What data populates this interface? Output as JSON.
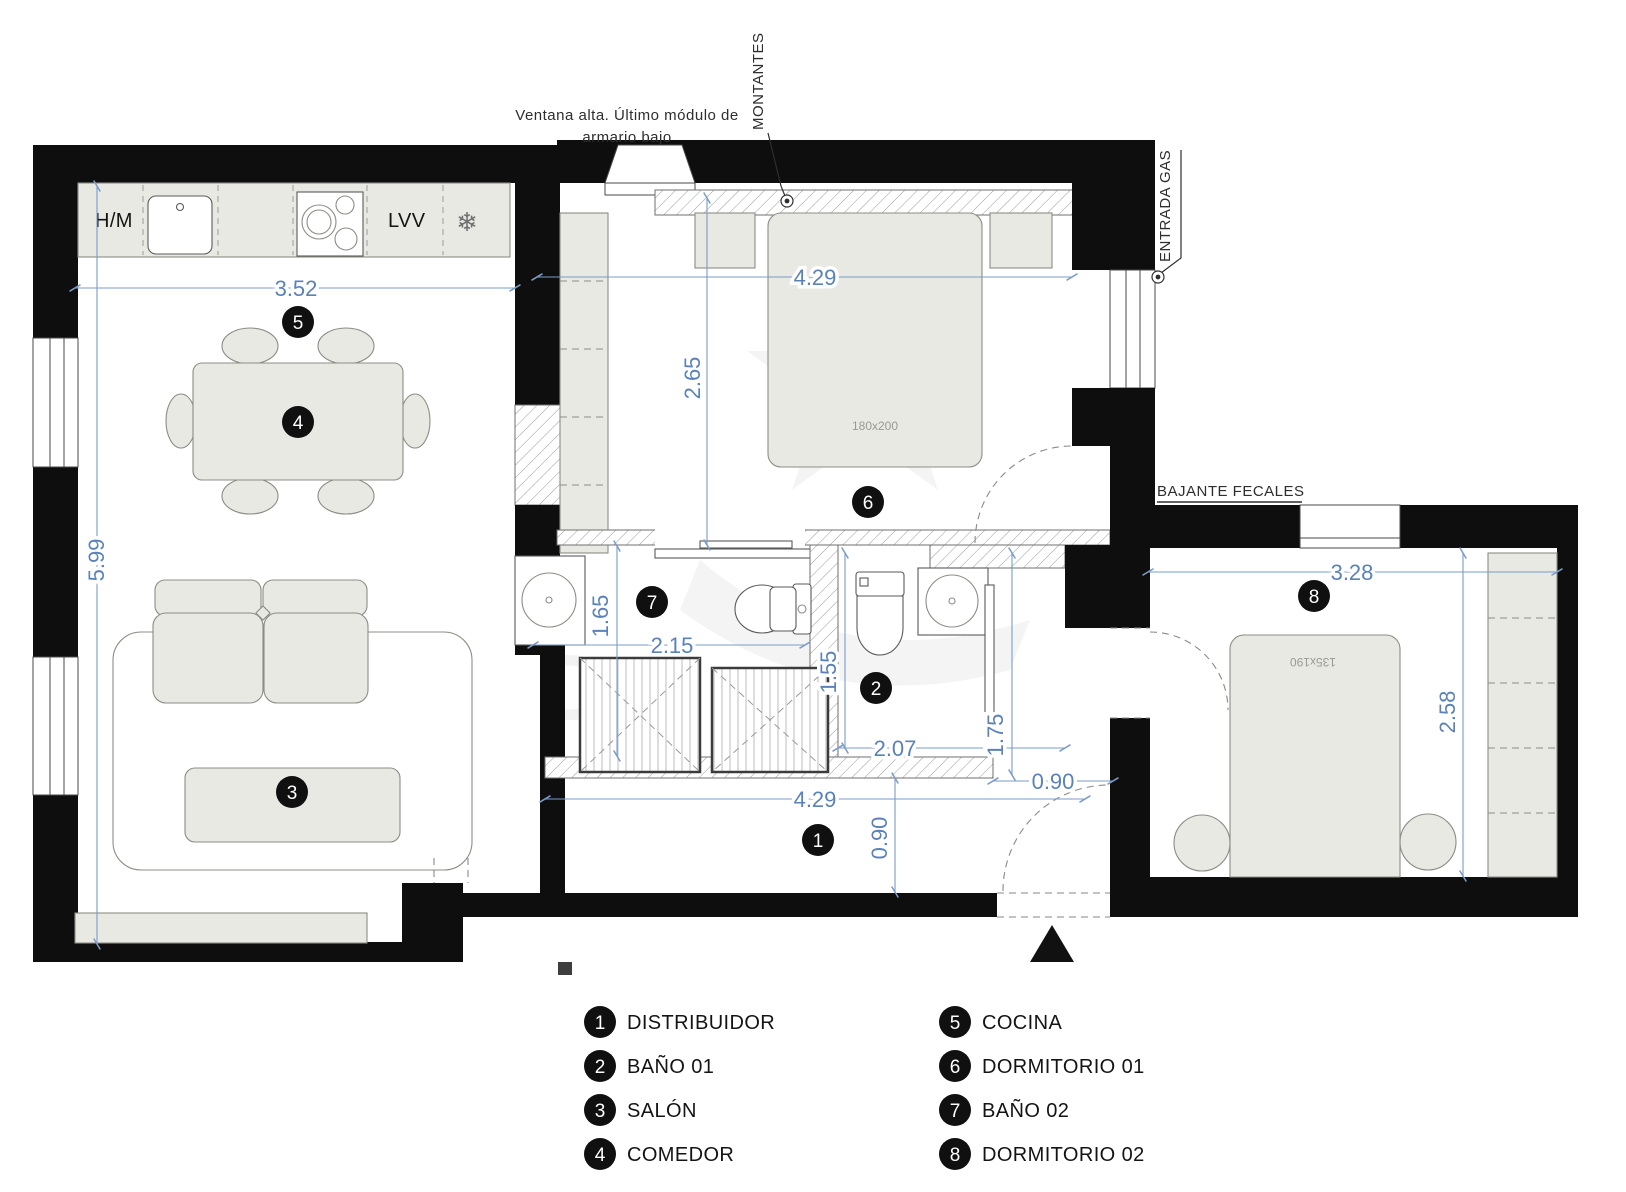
{
  "annotations": {
    "ventana_alta_line1": "Ventana alta. Último módulo de",
    "ventana_alta_line2": "armario bajo",
    "montantes": "MONTANTES",
    "entrada_gas": "ENTRADA GAS",
    "bajante_fecales": "BAJANTE FECALES"
  },
  "kitchen": {
    "hm": "H/M",
    "lvv": "LVV",
    "freezer_icon": "❄"
  },
  "beds": {
    "dorm1_bed_size": "180x200",
    "dorm2_bed_size": "135x190"
  },
  "dimensions": {
    "kitchen_width": "3.52",
    "salon_height": "5.99",
    "dorm1_width": "4.29",
    "dorm1_depth": "2.65",
    "bath2_depth": "1.65",
    "bath2_width": "2.15",
    "bath1_depth": "1.55",
    "bath1_width": "2.07",
    "shower_depth": "1.75",
    "entry_door_width": "0.90",
    "hall_width": "4.29",
    "hall_depth": "0.90",
    "dorm2_width": "3.28",
    "dorm2_depth": "2.58"
  },
  "markers": {
    "m1": "1",
    "m2": "2",
    "m3": "3",
    "m4": "4",
    "m5": "5",
    "m6": "6",
    "m7": "7",
    "m8": "8"
  },
  "legend": {
    "col1": [
      {
        "num": "1",
        "label": "DISTRIBUIDOR"
      },
      {
        "num": "2",
        "label": "BAÑO 01"
      },
      {
        "num": "3",
        "label": "SALÓN"
      },
      {
        "num": "4",
        "label": "COMEDOR"
      }
    ],
    "col2": [
      {
        "num": "5",
        "label": "COCINA"
      },
      {
        "num": "6",
        "label": "DORMITORIO 01"
      },
      {
        "num": "7",
        "label": "BAÑO 02"
      },
      {
        "num": "8",
        "label": "DORMITORIO 02"
      }
    ]
  },
  "colors": {
    "wall": "#0e0e0e",
    "furniture": "#e9e9e4",
    "dimension_blue": "#5b82b8"
  }
}
